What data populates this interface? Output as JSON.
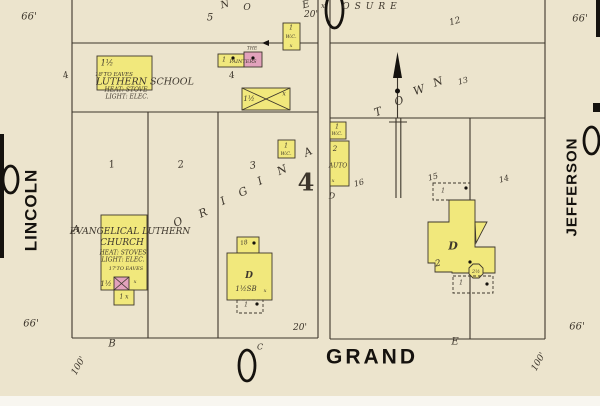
{
  "map": {
    "palette": {
      "paper": "#ece4cd",
      "yellow": "#f1e87c",
      "pink": "#e2a2bc",
      "ink": "#3d362c",
      "black": "#15120e",
      "paper_edge": "#f8f6f0"
    },
    "streets": {
      "left": "LINCOLN",
      "right": "JEFFERSON",
      "bottom": "GRAND"
    },
    "plat_words": {
      "diagonal": "ORIGINAL TOWN",
      "block_number": "4",
      "exposure_partial": "OSURE"
    },
    "bars": [
      [
        0,
        134,
        4,
        124
      ],
      [
        596,
        0,
        4,
        37
      ],
      [
        593,
        103,
        7,
        9
      ]
    ],
    "ovals": [
      [
        3,
        166,
        15,
        27
      ],
      [
        584,
        127,
        15,
        27
      ],
      [
        239,
        350,
        16,
        31
      ],
      [
        326,
        -8,
        17,
        36
      ]
    ],
    "lines": [
      [
        72,
        0,
        72,
        338
      ],
      [
        318,
        0,
        318,
        338
      ],
      [
        72,
        43,
        318,
        43
      ],
      [
        72,
        112,
        318,
        112
      ],
      [
        148,
        112,
        148,
        338
      ],
      [
        218,
        112,
        218,
        338
      ],
      [
        72,
        338,
        318,
        338
      ],
      [
        330,
        0,
        330,
        339
      ],
      [
        545,
        0,
        545,
        339
      ],
      [
        330,
        43,
        545,
        43
      ],
      [
        330,
        118,
        545,
        118
      ],
      [
        470,
        118,
        470,
        339
      ],
      [
        330,
        339,
        545,
        339
      ],
      [
        397.5,
        75,
        397.5,
        118
      ],
      [
        396,
        118,
        396,
        198
      ],
      [
        400.8,
        118,
        400.8,
        198
      ],
      [
        389,
        122,
        407,
        122
      ],
      [
        263,
        43,
        283,
        43
      ]
    ],
    "buildings": [
      {
        "n": "lutheran-school",
        "x": 97,
        "y": 56,
        "w": 55,
        "h": 34,
        "f": "y"
      },
      {
        "n": "painters-shop-left",
        "x": 218,
        "y": 54,
        "w": 26,
        "h": 13,
        "f": "y"
      },
      {
        "n": "painters-shop-right",
        "x": 244,
        "y": 52,
        "w": 18,
        "h": 15,
        "f": "p"
      },
      {
        "n": "wc-outbuilding-1",
        "x": 283,
        "y": 23,
        "w": 17,
        "h": 27,
        "f": "y"
      },
      {
        "n": "barn-x-roof",
        "x": 242,
        "y": 88,
        "w": 48,
        "h": 22,
        "f": "y",
        "cross": true
      },
      {
        "n": "wc-outbuilding-2",
        "x": 278,
        "y": 140,
        "w": 17,
        "h": 18,
        "f": "y"
      },
      {
        "n": "evangelical-church",
        "x": 101,
        "y": 215,
        "w": 46,
        "h": 75,
        "f": "y"
      },
      {
        "n": "church-tower",
        "x": 114,
        "y": 277,
        "w": 15,
        "h": 13,
        "f": "p",
        "cross": true
      },
      {
        "n": "church-extension",
        "x": 114,
        "y": 290,
        "w": 20,
        "h": 15,
        "f": "y"
      },
      {
        "n": "mid-dwelling-rear",
        "x": 237,
        "y": 237,
        "w": 22,
        "h": 16,
        "f": "y"
      },
      {
        "n": "mid-dwelling",
        "x": 227,
        "y": 253,
        "w": 45,
        "h": 47,
        "f": "y"
      },
      {
        "n": "mid-dwelling-porch",
        "x": 237,
        "y": 300,
        "w": 26,
        "h": 13,
        "f": "n",
        "dash": true
      },
      {
        "n": "wc-outbuilding-3",
        "x": 330,
        "y": 122,
        "w": 16,
        "h": 17,
        "f": "y"
      },
      {
        "n": "auto-house",
        "x": 330,
        "y": 141,
        "w": 19,
        "h": 45,
        "f": "y"
      },
      {
        "n": "dwelling-porch-top",
        "x": 433,
        "y": 183,
        "w": 37,
        "h": 17,
        "f": "n",
        "dash": true
      },
      {
        "n": "dwelling-main",
        "poly": "449,200 475,200 475,247 495,247 495,273 452,273 452,272 435,272 435,263 428,263 428,222 449,222",
        "f": "y"
      },
      {
        "n": "dwelling-bay",
        "poly": "475,222 487,222 476,243",
        "f": "y"
      },
      {
        "n": "dwelling-octagon",
        "poly": "469,268 473,264 479,264 483,268 483,274 479,278 473,278 469,274",
        "f": "y"
      },
      {
        "n": "dwelling-porch-bottom",
        "x": 453,
        "y": 276,
        "w": 40,
        "h": 17,
        "f": "n",
        "dash": true
      }
    ],
    "tris": [
      {
        "n": "north-arrow-head",
        "pts": "393,78 402,78 397.5,52"
      },
      {
        "n": "dimension-arrowhead",
        "pts": "262,43 269,40 269,46"
      }
    ],
    "dots": [
      [
        233,
        58
      ],
      [
        253,
        58
      ],
      [
        254,
        243
      ],
      [
        397.5,
        91,
        2.5
      ],
      [
        466,
        188
      ],
      [
        470,
        262
      ],
      [
        487,
        284
      ],
      [
        257,
        304
      ]
    ],
    "labels": [
      {
        "n": "dim-66-top-left",
        "t": "66'",
        "x": 29,
        "y": 17,
        "s": 10
      },
      {
        "n": "lot-5",
        "t": "5",
        "x": 210,
        "y": 18,
        "s": 10
      },
      {
        "n": "letter-n-top",
        "t": "N",
        "x": 225,
        "y": 5,
        "s": 10,
        "r": -15
      },
      {
        "n": "letter-o-top",
        "t": "O",
        "x": 247,
        "y": 8,
        "s": 9
      },
      {
        "n": "letter-e-top",
        "t": "E",
        "x": 306,
        "y": 5,
        "s": 10,
        "r": -15
      },
      {
        "n": "dim-20-top",
        "t": "20'",
        "x": 311,
        "y": 15,
        "s": 9
      },
      {
        "n": "x-mark-top",
        "t": "x",
        "x": 323,
        "y": 6,
        "s": 7
      },
      {
        "n": "word-osure",
        "t": "OSURE",
        "x": 372,
        "y": 7,
        "s": 9,
        "sp": 5
      },
      {
        "n": "lot-12",
        "t": "12",
        "x": 455,
        "y": 22,
        "s": 9,
        "r": -15
      },
      {
        "n": "dim-66-top-right",
        "t": "66'",
        "x": 580,
        "y": 19,
        "s": 10
      },
      {
        "n": "mark-left-4",
        "t": "4",
        "x": 66,
        "y": 76,
        "s": 9,
        "r": -20
      },
      {
        "n": "school-stories",
        "t": "1½",
        "x": 107,
        "y": 63,
        "s": 8
      },
      {
        "n": "school-eaves",
        "t": "18'TO EAVES",
        "x": 114,
        "y": 75,
        "s": 5.5
      },
      {
        "n": "school-name",
        "t": "LUTHERN SCHOOL",
        "x": 145,
        "y": 82,
        "s": 9.5
      },
      {
        "n": "school-heat",
        "t": "HEAT: STOVE",
        "x": 126,
        "y": 90,
        "s": 6
      },
      {
        "n": "school-light",
        "t": "LIGHT: ELEC.",
        "x": 127,
        "y": 97,
        "s": 6
      },
      {
        "n": "lot-4-small",
        "t": "4",
        "x": 232,
        "y": 76,
        "s": 9,
        "r": -10
      },
      {
        "n": "painters-stories",
        "t": "1",
        "x": 224,
        "y": 60,
        "s": 6
      },
      {
        "n": "painters-label",
        "t": "PAINTERS",
        "x": 243,
        "y": 62,
        "s": 5
      },
      {
        "n": "painters-the",
        "t": "THE",
        "x": 252,
        "y": 49,
        "s": 4.5
      },
      {
        "n": "wc1-stories",
        "t": "1",
        "x": 291,
        "y": 28,
        "s": 6
      },
      {
        "n": "wc1-label",
        "t": "W.C.",
        "x": 291,
        "y": 37,
        "s": 5
      },
      {
        "n": "wc1-x",
        "t": "x",
        "x": 291,
        "y": 46,
        "s": 5
      },
      {
        "n": "barn-stories",
        "t": "1½",
        "x": 249,
        "y": 99,
        "s": 7
      },
      {
        "n": "barn-x",
        "t": "x",
        "x": 284,
        "y": 94,
        "s": 6
      },
      {
        "n": "lot-1",
        "t": "1",
        "x": 112,
        "y": 165,
        "s": 10,
        "r": -10
      },
      {
        "n": "lot-2",
        "t": "2",
        "x": 181,
        "y": 165,
        "s": 10,
        "r": -10
      },
      {
        "n": "lot-3",
        "t": "3",
        "x": 253,
        "y": 166,
        "s": 10,
        "r": -10
      },
      {
        "n": "wc2-stories",
        "t": "1",
        "x": 286,
        "y": 146,
        "s": 6
      },
      {
        "n": "wc2-label",
        "t": "W.C.",
        "x": 286,
        "y": 154,
        "s": 5
      },
      {
        "n": "original-o",
        "t": "O",
        "x": 178,
        "y": 222,
        "s": 11,
        "r": -25
      },
      {
        "n": "original-r",
        "t": "R",
        "x": 203,
        "y": 213,
        "s": 11,
        "r": -25
      },
      {
        "n": "original-i1",
        "t": "I",
        "x": 223,
        "y": 201,
        "s": 11,
        "r": -25
      },
      {
        "n": "original-g",
        "t": "G",
        "x": 243,
        "y": 192,
        "s": 11,
        "r": -25
      },
      {
        "n": "original-i2",
        "t": "I",
        "x": 260,
        "y": 181,
        "s": 11,
        "r": -25
      },
      {
        "n": "original-n",
        "t": "N",
        "x": 282,
        "y": 170,
        "s": 11,
        "r": -25
      },
      {
        "n": "original-a",
        "t": "A",
        "x": 308,
        "y": 152,
        "s": 11,
        "r": -25
      },
      {
        "n": "block-number-4",
        "t": "4",
        "x": 306,
        "y": 182,
        "s": 24,
        "f": "serif-b"
      },
      {
        "n": "corner-a",
        "t": "A",
        "x": 76,
        "y": 230,
        "s": 9
      },
      {
        "n": "church-name-1",
        "t": "EVANGELICAL LUTHERN",
        "x": 130,
        "y": 232,
        "s": 9
      },
      {
        "n": "church-name-2",
        "t": "CHURCH",
        "x": 122,
        "y": 243,
        "s": 9
      },
      {
        "n": "church-heat",
        "t": "HEAT: STOVES",
        "x": 123,
        "y": 253,
        "s": 6
      },
      {
        "n": "church-light",
        "t": "LIGHT: ELEC.",
        "x": 123,
        "y": 260,
        "s": 6
      },
      {
        "n": "church-eaves",
        "t": "17'TO EAVES",
        "x": 126,
        "y": 269,
        "s": 5
      },
      {
        "n": "church-stories",
        "t": "1½",
        "x": 106,
        "y": 284,
        "s": 7
      },
      {
        "n": "church-x",
        "t": "x",
        "x": 135,
        "y": 282,
        "s": 5
      },
      {
        "n": "church-ext-label",
        "t": "1 x",
        "x": 124,
        "y": 297,
        "s": 6
      },
      {
        "n": "mid-rear-label",
        "t": "18",
        "x": 244,
        "y": 243,
        "s": 6,
        "r": -10
      },
      {
        "n": "mid-d",
        "t": "D",
        "x": 249,
        "y": 276,
        "s": 9,
        "f": "serif-bi"
      },
      {
        "n": "mid-stories",
        "t": "1½SB",
        "x": 246,
        "y": 289,
        "s": 7
      },
      {
        "n": "mid-x",
        "t": "x",
        "x": 265,
        "y": 291,
        "s": 5
      },
      {
        "n": "mid-porch-label",
        "t": "1",
        "x": 246,
        "y": 305,
        "s": 6
      },
      {
        "n": "town-t",
        "t": "T",
        "x": 378,
        "y": 112,
        "s": 11,
        "r": -20
      },
      {
        "n": "town-o",
        "t": "O",
        "x": 399,
        "y": 101,
        "s": 11,
        "r": -20
      },
      {
        "n": "town-w",
        "t": "W",
        "x": 419,
        "y": 90,
        "s": 11,
        "r": -20
      },
      {
        "n": "town-n",
        "t": "N",
        "x": 438,
        "y": 82,
        "s": 11,
        "r": -20
      },
      {
        "n": "lot-13",
        "t": "13",
        "x": 463,
        "y": 81,
        "s": 8,
        "r": -15
      },
      {
        "n": "lot-16",
        "t": "16",
        "x": 359,
        "y": 183,
        "s": 8,
        "r": -15
      },
      {
        "n": "lot-15",
        "t": "15",
        "x": 433,
        "y": 177,
        "s": 8,
        "r": -15
      },
      {
        "n": "lot-14",
        "t": "14",
        "x": 504,
        "y": 179,
        "s": 8,
        "r": -15
      },
      {
        "n": "wc3-stories",
        "t": "1",
        "x": 337,
        "y": 127,
        "s": 6
      },
      {
        "n": "wc3-label",
        "t": "W.C.",
        "x": 337,
        "y": 134,
        "s": 5
      },
      {
        "n": "auto-stories",
        "t": "2",
        "x": 335,
        "y": 149,
        "s": 7
      },
      {
        "n": "auto-label",
        "t": "AUTO",
        "x": 338,
        "y": 166,
        "s": 6
      },
      {
        "n": "auto-x",
        "t": "x",
        "x": 333,
        "y": 181,
        "s": 5
      },
      {
        "n": "letter-d",
        "t": "D",
        "x": 332,
        "y": 196,
        "s": 8
      },
      {
        "n": "dwelling-porch-top-label",
        "t": "1",
        "x": 443,
        "y": 191,
        "s": 6
      },
      {
        "n": "dwelling-d",
        "t": "D",
        "x": 453,
        "y": 246,
        "s": 11,
        "f": "serif-bi"
      },
      {
        "n": "dwelling-2",
        "t": "2",
        "x": 438,
        "y": 264,
        "s": 9,
        "r": -10
      },
      {
        "n": "dwelling-oct-label",
        "t": "2½",
        "x": 476,
        "y": 272,
        "s": 5
      },
      {
        "n": "dwelling-porch-bottom-label",
        "t": "1",
        "x": 461,
        "y": 283,
        "s": 6
      },
      {
        "n": "dim-20-bottom",
        "t": "20'",
        "x": 300,
        "y": 328,
        "s": 9
      },
      {
        "n": "corner-b",
        "t": "B",
        "x": 112,
        "y": 344,
        "s": 10
      },
      {
        "n": "corner-c",
        "t": "C",
        "x": 260,
        "y": 347,
        "s": 8
      },
      {
        "n": "street-grand",
        "t": "GRAND",
        "x": 372,
        "y": 357,
        "s": 21,
        "f": "sans-b",
        "sp": 3
      },
      {
        "n": "corner-e",
        "t": "E",
        "x": 455,
        "y": 342,
        "s": 10
      },
      {
        "n": "dim-66-bottom-left",
        "t": "66'",
        "x": 31,
        "y": 324,
        "s": 10
      },
      {
        "n": "dim-100-bottom-left",
        "t": "100'",
        "x": 79,
        "y": 366,
        "s": 9,
        "r": -60
      },
      {
        "n": "dim-66-bottom-right",
        "t": "66'",
        "x": 577,
        "y": 327,
        "s": 10
      },
      {
        "n": "dim-100-bottom-right",
        "t": "100'",
        "x": 539,
        "y": 362,
        "s": 9,
        "r": -60
      },
      {
        "n": "street-lincoln",
        "t": "LINCOLN",
        "x": 31,
        "y": 210,
        "s": 17,
        "f": "sans-b",
        "r": -90,
        "sp": 1
      },
      {
        "n": "street-jefferson",
        "t": "JEFFERSON",
        "x": 572,
        "y": 187,
        "s": 15,
        "f": "sans-b",
        "r": -90,
        "sp": 1
      }
    ]
  }
}
